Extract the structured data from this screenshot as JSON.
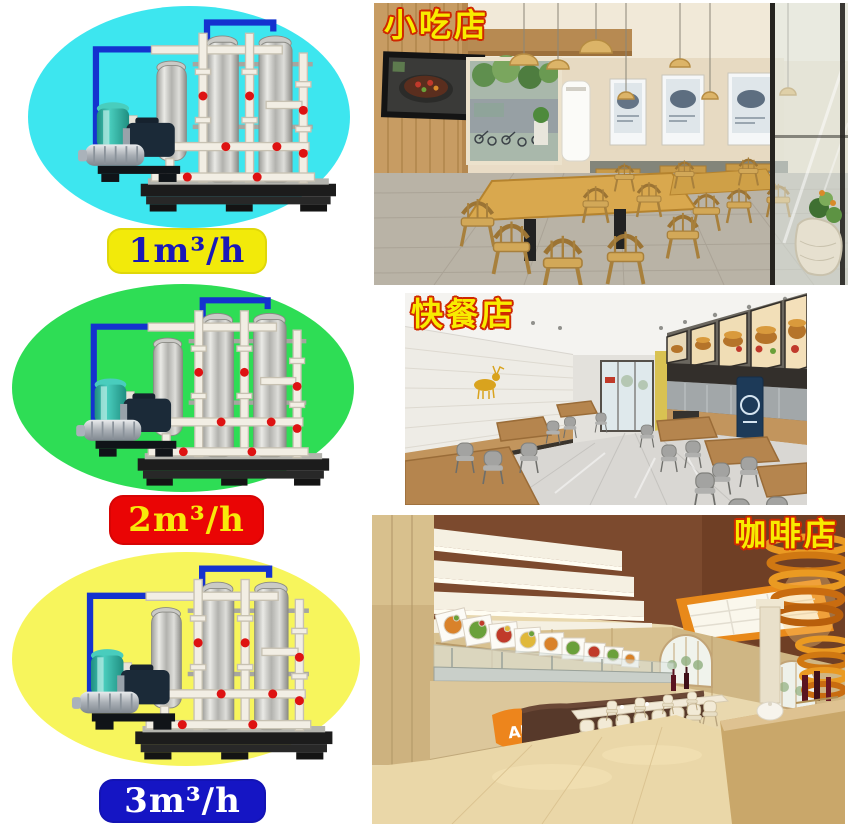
{
  "page": {
    "background": "#ffffff"
  },
  "products": [
    {
      "capacity_label": "1m³/h",
      "ellipse_color": "#3de6ef",
      "badge_bg": "#f2ea0a",
      "badge_fg": "#1a18b8"
    },
    {
      "capacity_label": "2m³/h",
      "ellipse_color": "#2edd55",
      "badge_bg": "#ea0505",
      "badge_fg": "#f8e80a"
    },
    {
      "capacity_label": "3m³/h",
      "ellipse_color": "#f7f55c",
      "badge_bg": "#1515c4",
      "badge_fg": "#ffffff"
    }
  ],
  "machine": {
    "description": "skid-mounted water purification unit",
    "pipe_color": "#1432cf",
    "tank_color": "#b9b9b4",
    "pvc_pipe_color": "#f2eee4",
    "valve_color": "#de1212",
    "pump_motor_color": "#1b2a38",
    "pressure_tank_color": "#35bfae",
    "base_color": "#1c1c1c"
  },
  "scenes": [
    {
      "label": "小吃店",
      "type": "snack-shop"
    },
    {
      "label": "快餐店",
      "type": "fast-food-restaurant"
    },
    {
      "label": "咖啡店",
      "type": "coffee-shop",
      "counter_logo_text": "AU"
    }
  ],
  "scene_labels": {
    "color": "#f8ec00",
    "outline": "#cf2800"
  }
}
